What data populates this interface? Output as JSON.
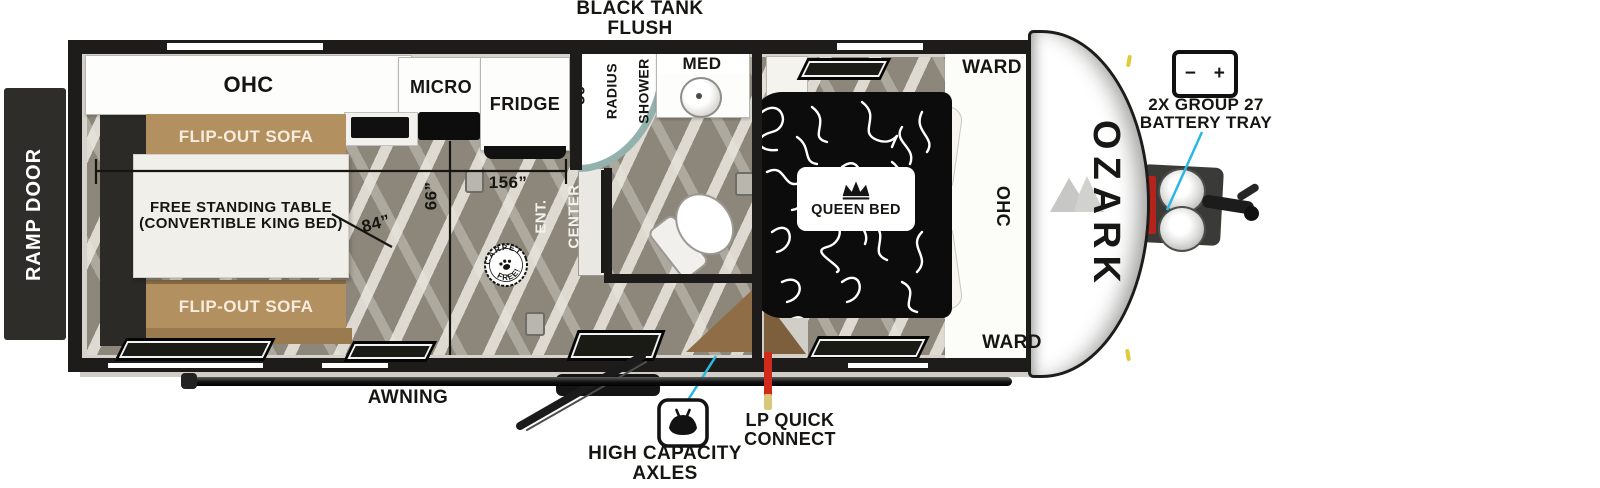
{
  "brand": {
    "name": "OZARK"
  },
  "callouts": {
    "black_tank_l1": "BLACK TANK",
    "black_tank_l2": "FLUSH",
    "battery_l1": "2X GROUP 27",
    "battery_l2": "BATTERY TRAY",
    "battery_minus": "−",
    "battery_plus": "+",
    "awning": "AWNING",
    "axles_l1": "HIGH CAPACITY",
    "axles_l2": "AXLES",
    "lp_l1": "LP QUICK",
    "lp_l2": "CONNECT",
    "ramp_door": "RAMP DOOR"
  },
  "living": {
    "ohc": "OHC",
    "sofa_top": "FLIP-OUT SOFA",
    "sofa_bottom": "FLIP-OUT SOFA",
    "table_l1": "FREE STANDING TABLE",
    "table_l2": "(CONVERTIBLE KING BED)",
    "ent_l1": "ENT.",
    "ent_l2": "CENTER",
    "badge_top": "CARPET",
    "badge_bottom": "FREE!"
  },
  "kitchen": {
    "micro": "MICRO",
    "fridge": "FRIDGE"
  },
  "bath": {
    "shower_dim": "36”",
    "shower_l1": "RADIUS",
    "shower_l2": "SHOWER",
    "med": "MED"
  },
  "bedroom": {
    "queen": "QUEEN BED",
    "ward_top": "WARD",
    "ward_bottom": "WARD",
    "ohc": "OHC"
  },
  "dimensions": {
    "main_length": "156”",
    "table_width": "84”",
    "aisle_width": "66”"
  },
  "colors": {
    "accent_cyan": "#2bb7e5",
    "lp_red": "#cf2a1c",
    "sofa_brown": "#b3905f",
    "floor_grey": "#8d877b",
    "wall_black": "#1d1c1a"
  }
}
